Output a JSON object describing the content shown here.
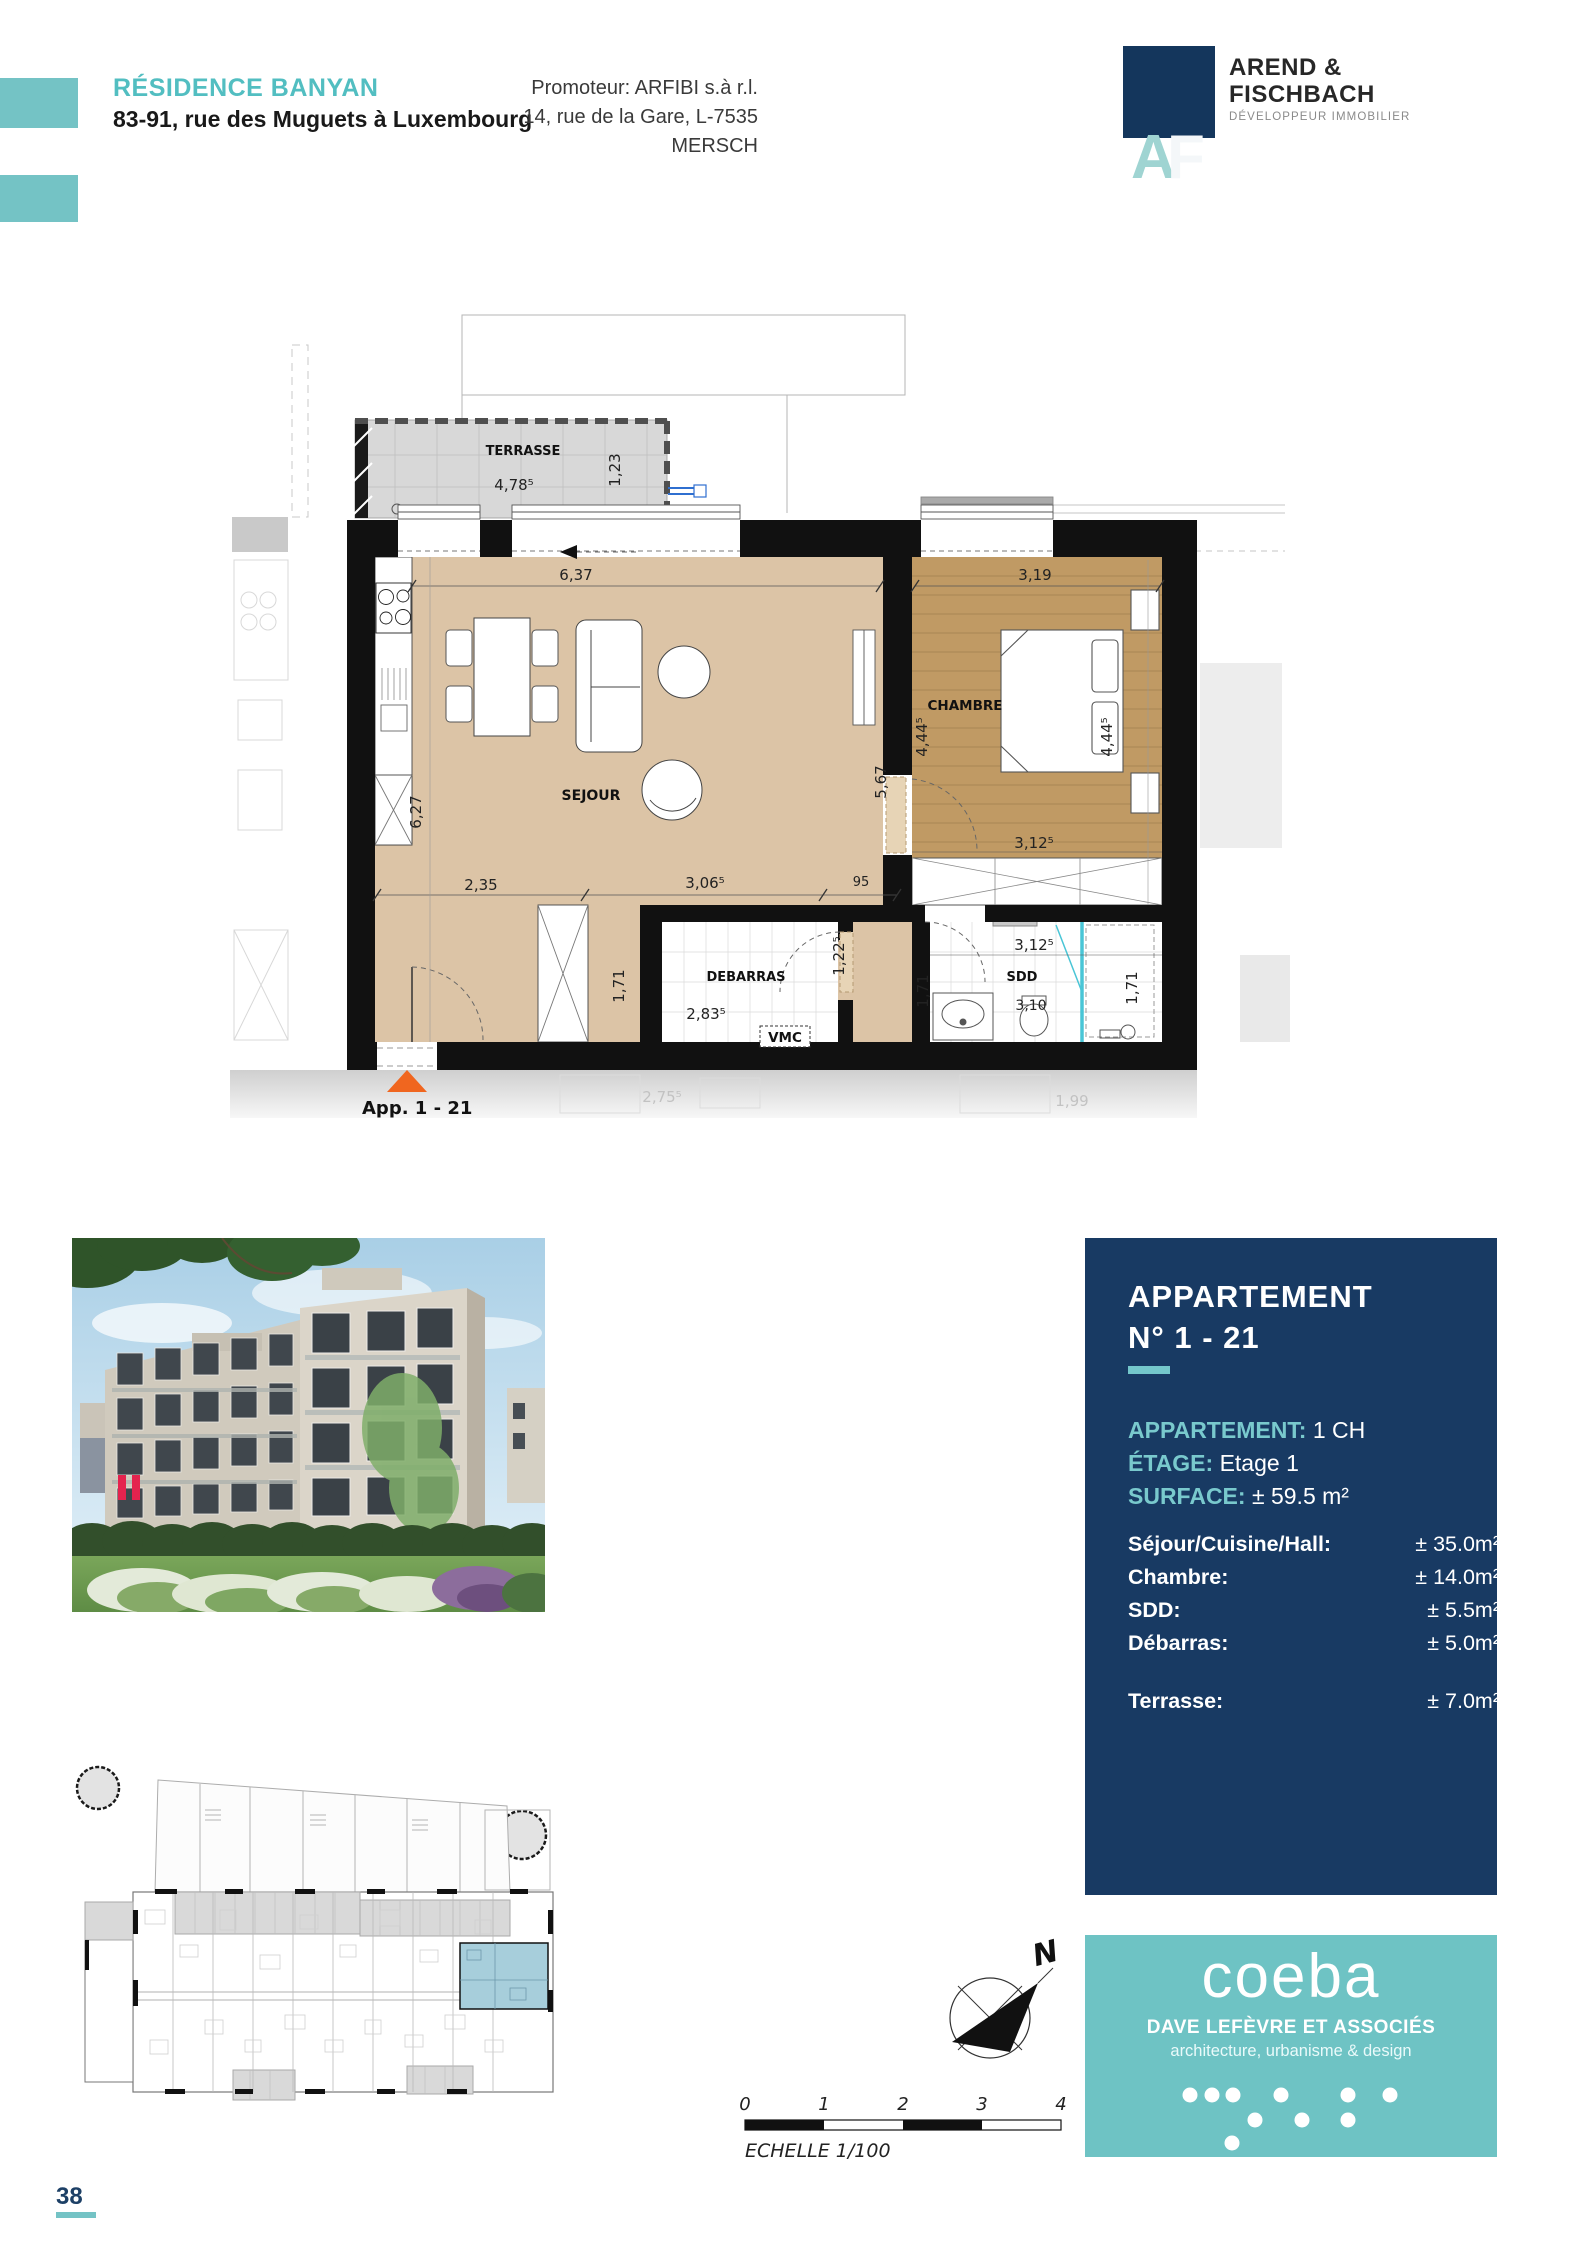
{
  "header": {
    "project": "RÉSIDENCE BANYAN",
    "address": "83-91, rue des Muguets à Luxembourg",
    "promoter1": "Promoteur: ARFIBI s.à r.l.",
    "promoter2": "14, rue de la Gare, L-7535 MERSCH",
    "logo": {
      "a": "A",
      "f": "F",
      "name1": "AREND &",
      "name2": "FISCHBACH",
      "tagline": "DÉVELOPPEUR IMMOBILIER"
    }
  },
  "plan": {
    "labels": {
      "terrasse": "TERRASSE",
      "sejour": "SEJOUR",
      "chambre": "CHAMBRE",
      "debarras": "DEBARRAS",
      "sdd": "SDD",
      "vmc": "VMC",
      "vmc_neighbor": "VMC"
    },
    "dims": {
      "terrace_w": "4,78⁵",
      "terrace_d": "1,23",
      "sejour_w": "6,37",
      "sejour_h": "6,27",
      "sejour_right": "5,67",
      "chambre_w": "3,19",
      "chambre_h_left": "4,44⁵",
      "chambre_h_right": "4,44⁵",
      "chambre_bottom": "3,12⁵",
      "entry_1": "2,35",
      "entry_2": "3,06⁵",
      "entry_3": "95",
      "debarras_h": "1,71",
      "debarras_w": "2,83⁵",
      "debarras_door": "1,22⁵",
      "sdd_w": "3,12⁵",
      "sdd_h_left": "1,71",
      "sdd_h_right": "1,71",
      "wc": "3,10",
      "faded_a": "2,75⁵",
      "faded_b": "1,99"
    },
    "entrance": "App. 1 - 21"
  },
  "info": {
    "title1": "APPARTEMENT",
    "title2": "N° 1 - 21",
    "spec": [
      {
        "label": "APPARTEMENT:",
        "value": "1 CH"
      },
      {
        "label": "ÉTAGE:",
        "value": "Etage 1"
      },
      {
        "label": "SURFACE:",
        "value": "± 59.5 m²"
      }
    ],
    "areas": [
      {
        "label": "Séjour/Cuisine/Hall:",
        "value": "± 35.0m²"
      },
      {
        "label": "Chambre:",
        "value": "± 14.0m²"
      },
      {
        "label": "SDD:",
        "value": "± 5.5m²"
      },
      {
        "label": "Débarras:",
        "value": "± 5.0m²"
      },
      {
        "label": "Terrasse:",
        "value": "± 7.0m²"
      }
    ]
  },
  "compass": {
    "north": "N"
  },
  "scalebar": {
    "ticks": [
      "0",
      "1",
      "2",
      "3",
      "4"
    ],
    "caption": "ECHELLE  1/100"
  },
  "coeba": {
    "brand": "coeba",
    "subtitle": "DAVE LEFÈVRE ET ASSOCIÉS",
    "tagline": "architecture, urbanisme & design"
  },
  "footer": {
    "page": "38"
  }
}
